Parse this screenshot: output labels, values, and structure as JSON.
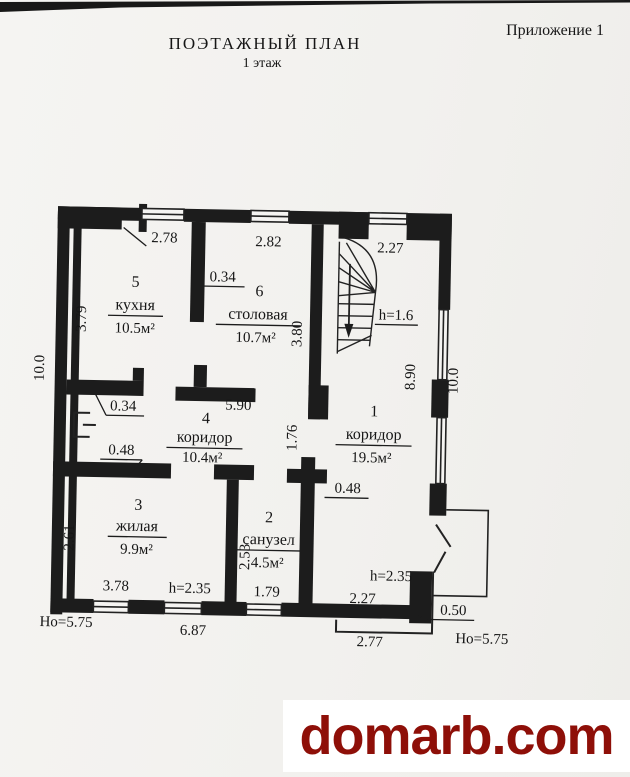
{
  "page": {
    "annex": "Приложение 1",
    "title": "ПОЭТАЖНЫЙ ПЛАН",
    "subtitle": "1 этаж",
    "watermark": "domarb.com",
    "watermark_color": "#8e0f08"
  },
  "rooms": [
    {
      "number": "1",
      "name": "коридор",
      "area": "19.5м²"
    },
    {
      "number": "2",
      "name": "санузел",
      "area": "4.5м²"
    },
    {
      "number": "3",
      "name": "жилая",
      "area": "9.9м²"
    },
    {
      "number": "4",
      "name": "коридор",
      "area": "10.4м²"
    },
    {
      "number": "5",
      "name": "кухня",
      "area": "10.5м²"
    },
    {
      "number": "6",
      "name": "столовая",
      "area": "10.7м²"
    }
  ],
  "dims": {
    "win_kitchen": "2.78",
    "win_dining": "2.82",
    "stair_width": "2.27",
    "wall_034_top": "0.34",
    "kitchen_left": "3.79",
    "left_total": "10.0",
    "dining_right": "3.80",
    "stair_h": "h=1.6",
    "right_upper": "8.90",
    "right_total": "10.0",
    "corridor4_width": "5.90",
    "wall_034_mid": "0.34",
    "passage_176": "1.76",
    "wall_048_left": "0.48",
    "wall_048_right": "0.48",
    "room3_left": "2.61",
    "room3_width": "3.78",
    "room3_h": "h=2.35",
    "room2_left": "2.53",
    "room2_width": "1.79",
    "room1_h": "h=2.35",
    "room1_width": "2.27",
    "wall_050": "0.50",
    "ho_left": "Но=5.75",
    "bottom_mid": "6.87",
    "bottom_right": "2.77",
    "ho_right": "Но=5.75"
  }
}
